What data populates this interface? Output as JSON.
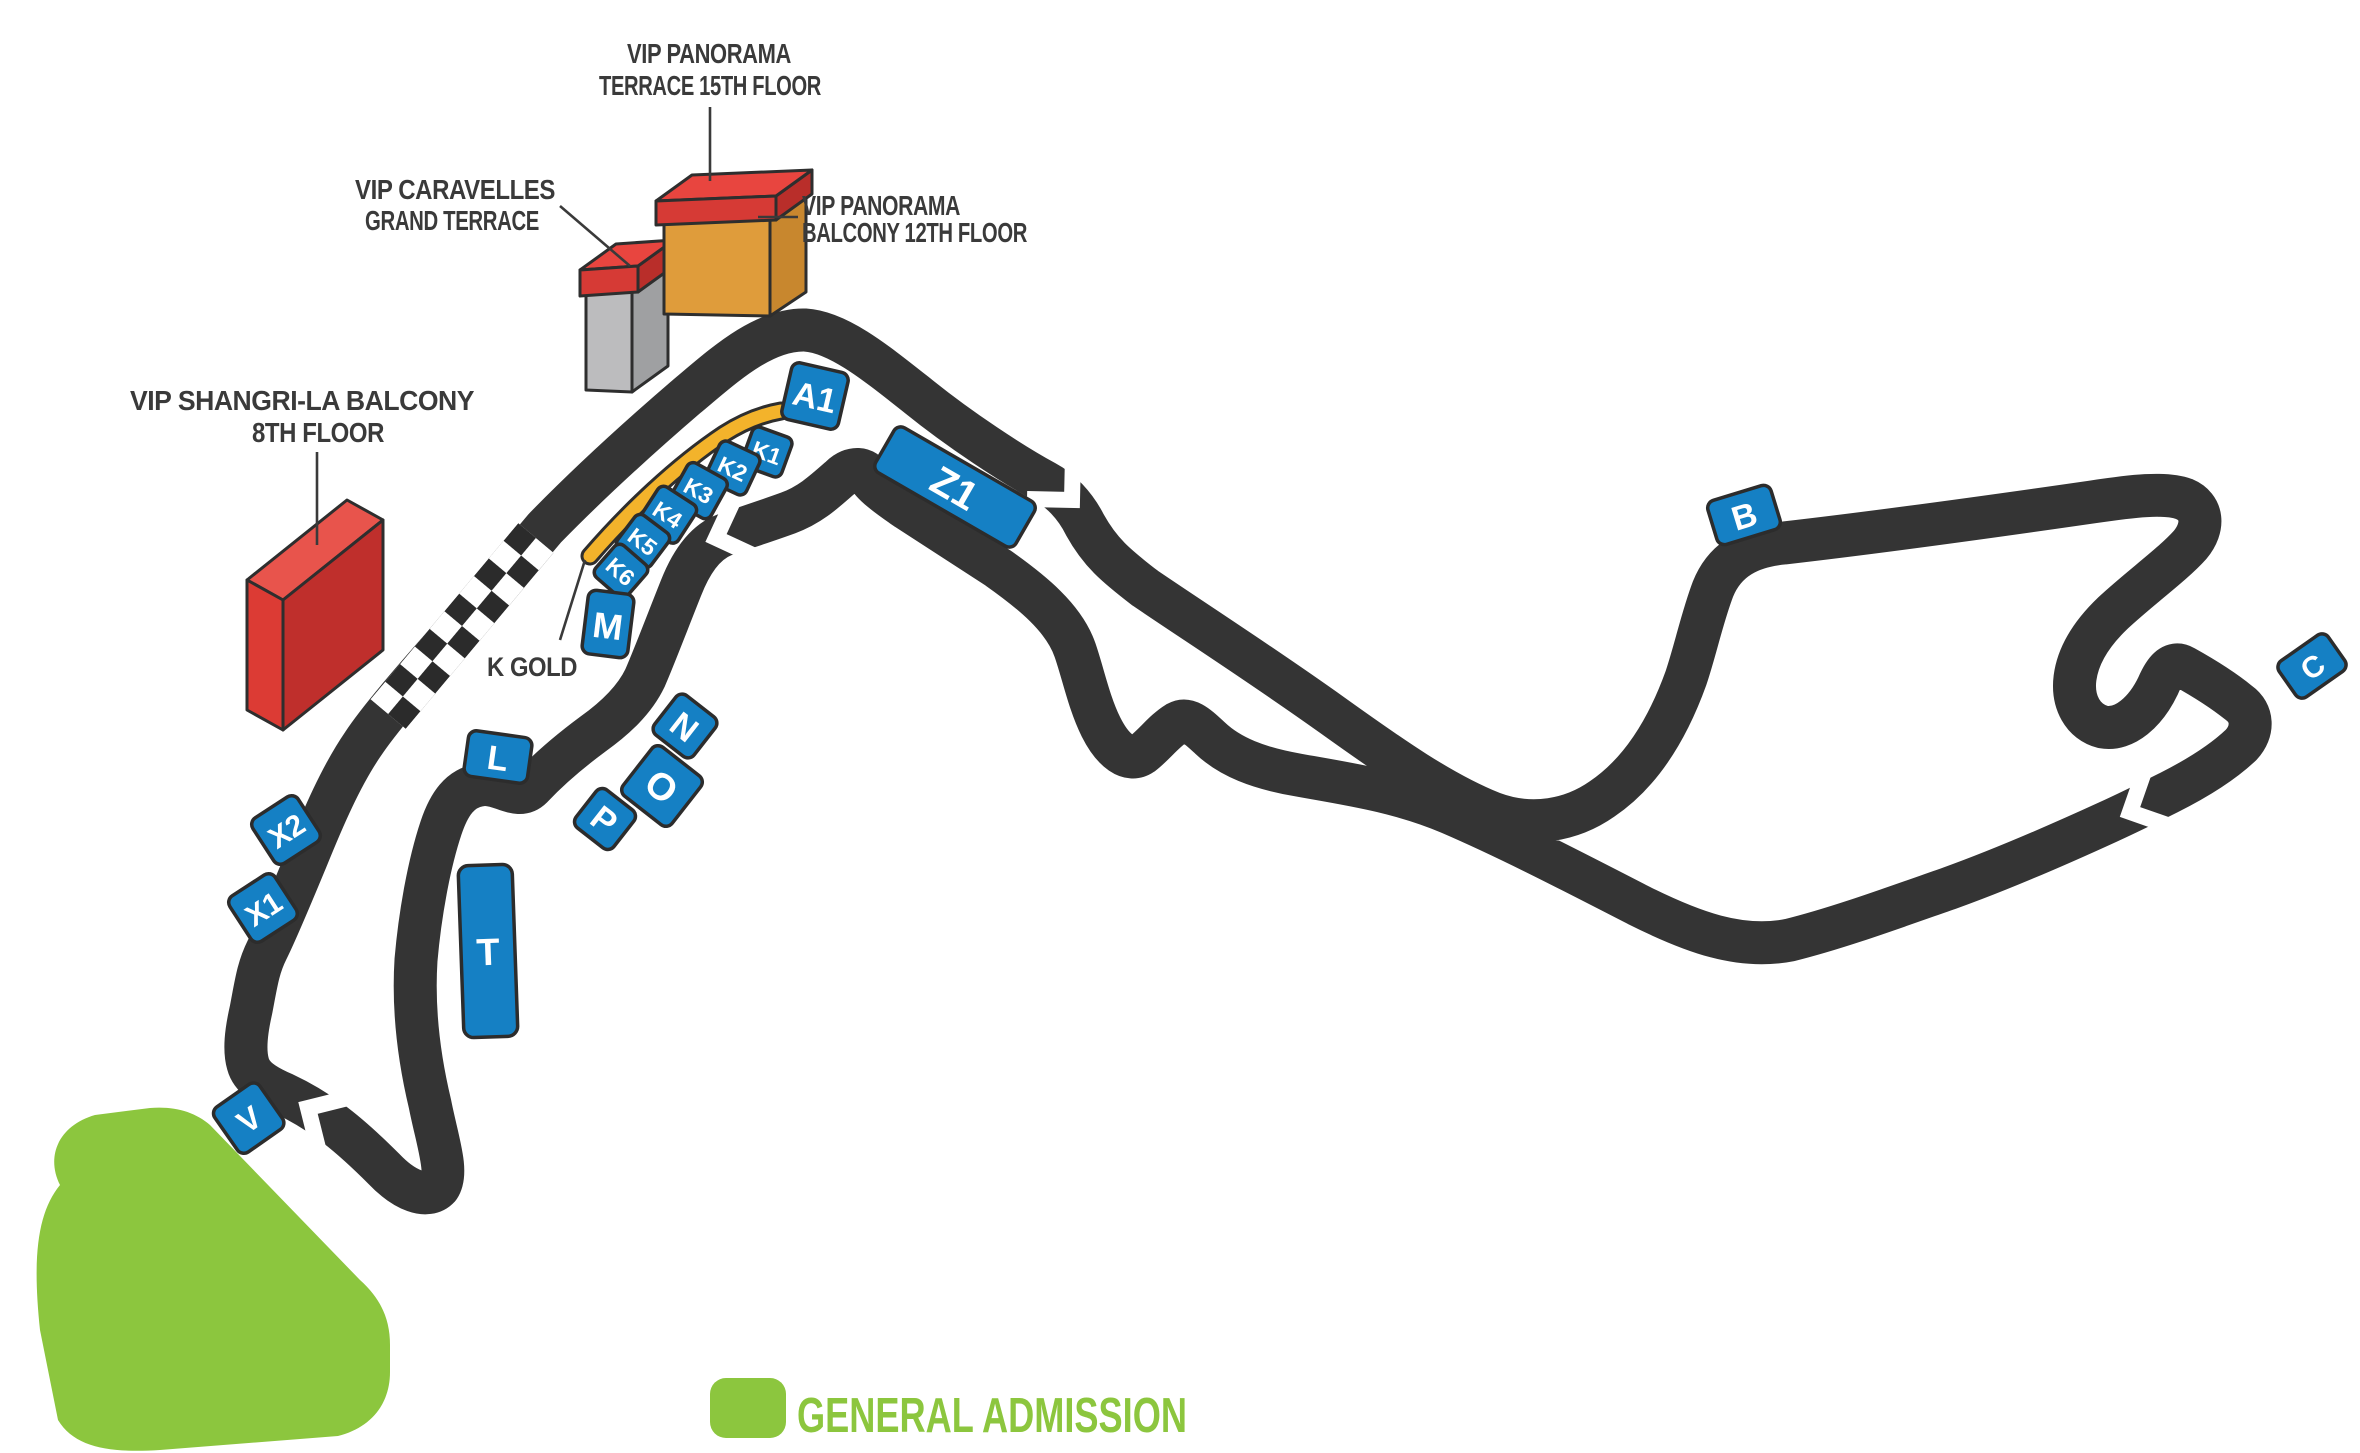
{
  "map": {
    "legend": {
      "general_admission": "GENERAL ADMISSION"
    },
    "annotations": {
      "panorama_terrace": {
        "line1": "VIP PANORAMA",
        "line2": "TERRACE 15TH FLOOR"
      },
      "panorama_balcony": {
        "line1": "VIP PANORAMA",
        "line2": "BALCONY 12TH FLOOR"
      },
      "caravelles": {
        "line1": "VIP CARAVELLES",
        "line2": "GRAND TERRACE"
      },
      "shangri_la": {
        "line1": "VIP SHANGRI-LA BALCONY",
        "line2": "8TH FLOOR"
      },
      "k_gold": "K GOLD"
    },
    "grandstands": {
      "a1": "A1",
      "z1": "Z1",
      "b": "B",
      "c": "C",
      "k1": "K1",
      "k2": "K2",
      "k3": "K3",
      "k4": "K4",
      "k5": "K5",
      "k6": "K6",
      "m": "M",
      "l": "L",
      "n": "N",
      "o": "O",
      "p": "P",
      "t": "T",
      "v": "V",
      "x1": "X1",
      "x2": "X2"
    },
    "colors": {
      "track": "#343434",
      "grandstand_blue": "#1580C4",
      "k_gold_strip": "#F3B32B",
      "general_admission_green": "#8CC63E",
      "vip_red": "#D93A35",
      "vip_orange": "#DF9C3B",
      "vip_gray": "#BCBCBE",
      "label_text": "#3A3A3A"
    }
  }
}
